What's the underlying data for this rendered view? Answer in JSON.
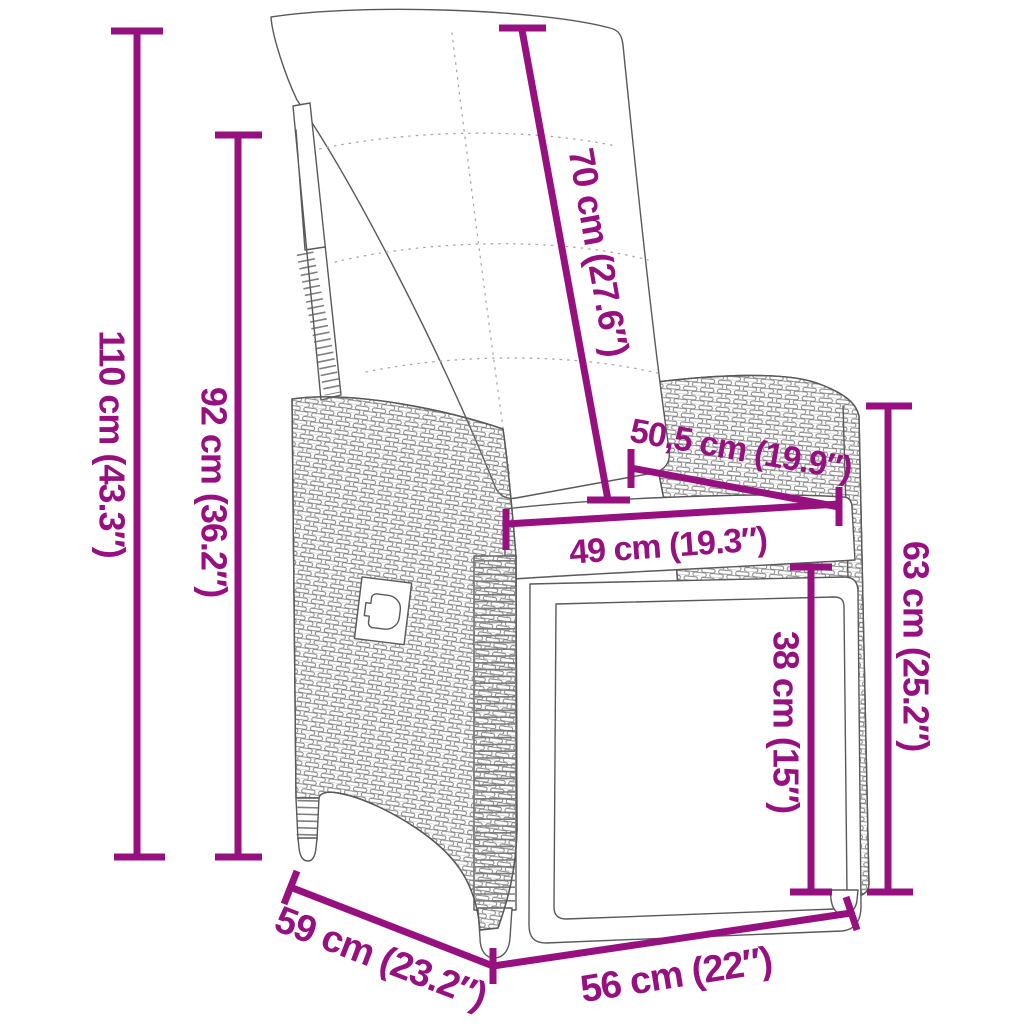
{
  "diagram": {
    "subject": "reclining poly rattan garden chair with cushions",
    "colors": {
      "dimension_accent": "#96117f",
      "line_art": "#595959",
      "weave": "#7d7d7d",
      "background": "#ffffff"
    },
    "labels": {
      "height_total": "110 cm (43.3″)",
      "height_backrest": "92 cm (36.2″)",
      "backrest_cushion_length": "70 cm (27.6″)",
      "backrest_top_depth": "50,5 cm (19.9″)",
      "seat_width": "49 cm (19.3″)",
      "armrest_height": "63 cm (25.2″)",
      "footrest_height": "38 cm (15″)",
      "base_depth": "59 cm (23.2″)",
      "base_width": "56 cm (22″)"
    }
  }
}
